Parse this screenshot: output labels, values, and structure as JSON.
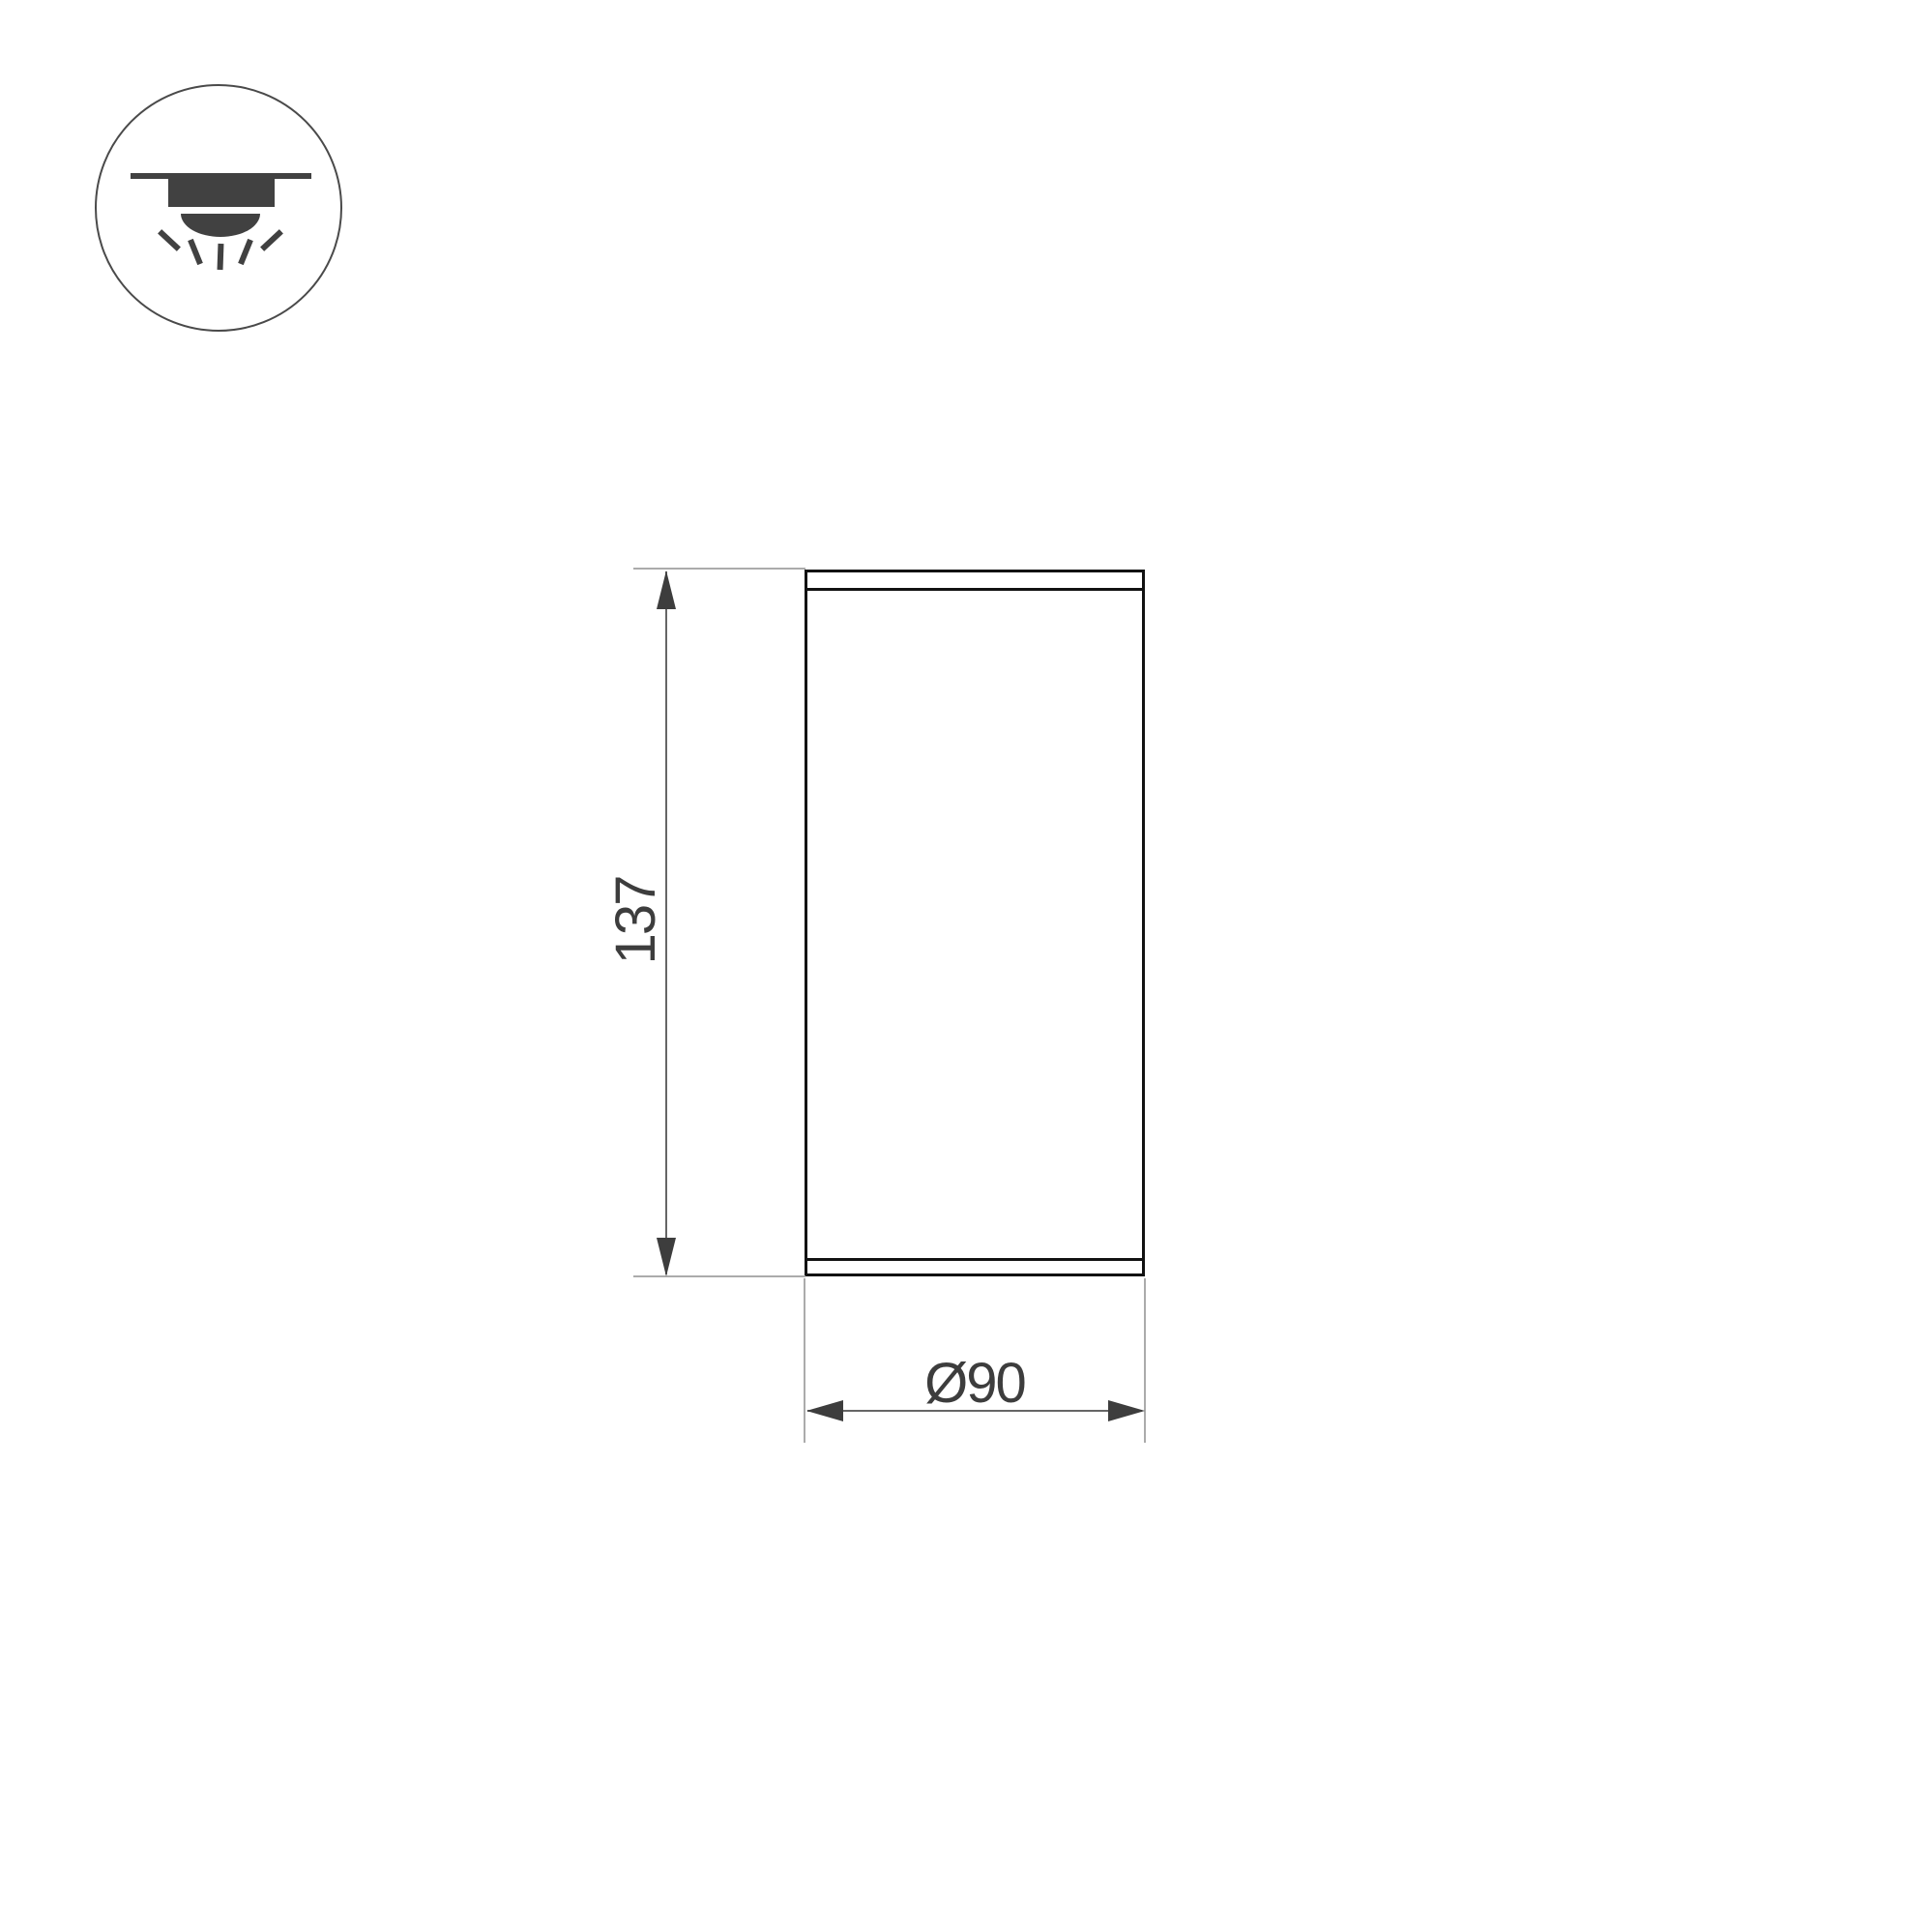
{
  "drawing": {
    "type": "technical-dimension-drawing",
    "subject": "surface-mounted cylindrical ceiling luminaire, front view",
    "dimensions": {
      "height": {
        "label": "137",
        "value": 137
      },
      "diameter": {
        "label": "Ø90",
        "value": 90
      }
    },
    "icon": {
      "semantic": "surface-mounted-ceiling-light-icon",
      "elements": [
        "ceiling-line",
        "fixture-body",
        "lens-dome",
        "light-rays"
      ]
    },
    "colors": {
      "background": "#ffffff",
      "outline": "#121212",
      "dimension_text": "#3d3d3d",
      "dimension_line": "#666666",
      "extension_line": "#ababab",
      "icon_fill": "#414141",
      "icon_circle_stroke": "#4a4a4a"
    }
  }
}
